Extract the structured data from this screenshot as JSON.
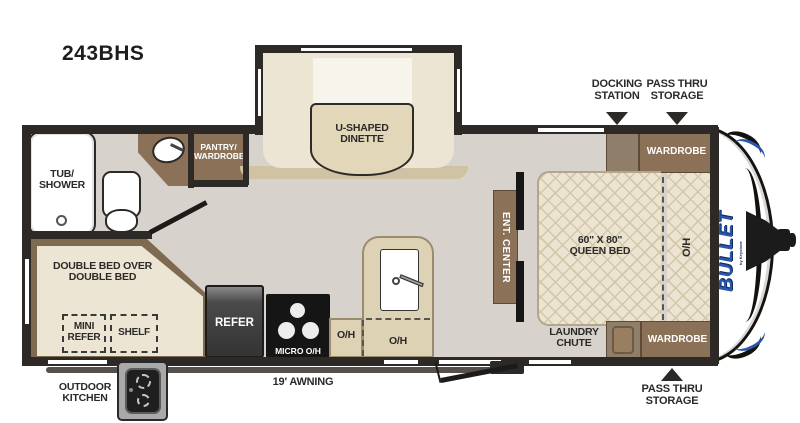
{
  "title": "243BHS",
  "brand": {
    "name": "BULLET",
    "sub": "by Keystone",
    "color": "#2a57ad"
  },
  "callouts": {
    "docking_station": {
      "line1": "DOCKING",
      "line2": "STATION"
    },
    "pass_thru_top": {
      "line1": "PASS THRU",
      "line2": "STORAGE"
    },
    "pass_thru_bottom": {
      "line1": "PASS THRU",
      "line2": "STORAGE"
    },
    "outdoor_kitchen": {
      "line1": "OUTDOOR",
      "line2": "KITCHEN"
    },
    "awning": "19' AWNING"
  },
  "rooms": {
    "tub_shower": {
      "line1": "TUB/",
      "line2": "SHOWER"
    },
    "pantry": {
      "line1": "PANTRY/",
      "line2": "WARDROBE"
    },
    "dinette": {
      "line1": "U-SHAPED",
      "line2": "DINETTE"
    },
    "bunk": {
      "line1": "DOUBLE BED OVER",
      "line2": "DOUBLE BED"
    },
    "mini_refer": {
      "line1": "MINI",
      "line2": "REFER"
    },
    "shelf": "SHELF",
    "refer": "REFER",
    "micro_oh": "MICRO O/H",
    "oh_1": "O/H",
    "oh_2": "O/H",
    "ent_center": "ENT. CENTER",
    "queen_bed": {
      "line1": "60\" X 80\"",
      "line2": "QUEEN BED"
    },
    "bed_oh": "O/H",
    "laundry": {
      "line1": "LAUNDRY",
      "line2": "CHUTE"
    },
    "wardrobe_top": "WARDROBE",
    "wardrobe_bottom": "WARDROBE"
  },
  "colors": {
    "wall": "#2d2926",
    "floor": "#d7d3cc",
    "cream": "#ece5d3",
    "tan_counter": "#ded2b4",
    "brown_cabinet": "#8a7157",
    "brown_light": "#8f7f6a",
    "bed_frame": "#7d6a50",
    "accent_blue": "#2a57ad"
  }
}
